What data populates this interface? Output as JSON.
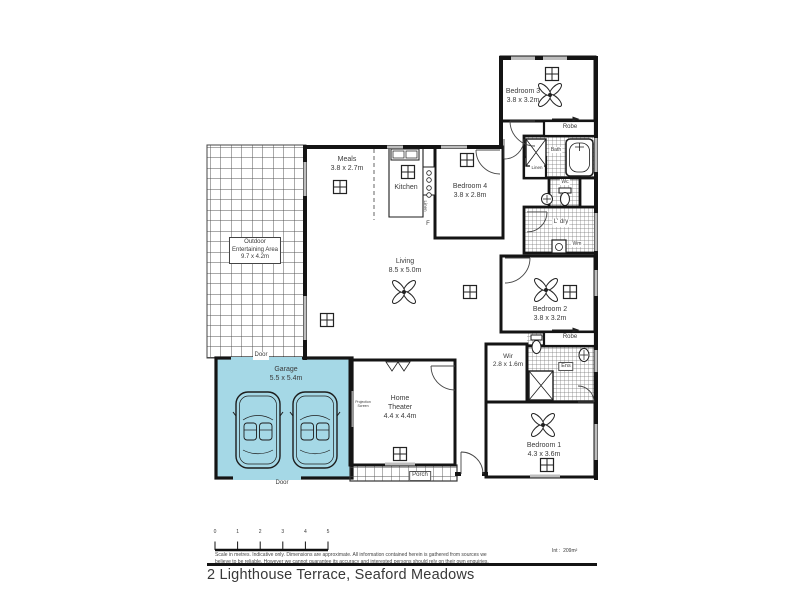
{
  "title": "2 Lighthouse Terrace, Seaford Meadows",
  "colors": {
    "garage_fill": "#a5d8e6",
    "wall": "#141414"
  },
  "rooms": {
    "outdoor": {
      "line1": "Outdoor",
      "line2": "Entertaining Area",
      "dims": "9.7 x 4.2m"
    },
    "meals": {
      "name": "Meals",
      "dims": "3.8 x 2.7m"
    },
    "kitchen": {
      "name": "Kitchen"
    },
    "fridge": "F",
    "linen_hall": "Linen",
    "bedroom4": {
      "name": "Bedroom 4",
      "dims": "3.8 x 2.8m"
    },
    "bedroom3": {
      "name": "Bedroom 3",
      "dims": "3.8 x 3.2m"
    },
    "robe_bed3": "Robe",
    "bath": "Bath",
    "linen_bath": "Linen",
    "wc": "Wc",
    "laundry": "L' dry",
    "washing_machine": "Wm",
    "living": {
      "name": "Living",
      "dims": "8.5 x 5.0m"
    },
    "bedroom2": {
      "name": "Bedroom 2",
      "dims": "3.8 x 3.2m"
    },
    "robe_bed2": "Robe",
    "ensuite": "Ens",
    "wir": {
      "name": "Wir",
      "dims": "2.8 x 1.6m"
    },
    "bedroom1": {
      "name": "Bedroom 1",
      "dims": "4.3 x 3.6m"
    },
    "garage": {
      "name": "Garage",
      "dims": "5.5 x 5.4m"
    },
    "door_top": "Door",
    "door_bottom": "Door",
    "theater": {
      "line1": "Home",
      "line2": "Theater",
      "dims": "4.4 x 4.4m"
    },
    "projection": {
      "line1": "Projection",
      "line2": "Screen"
    },
    "porch": "Porch"
  },
  "footer": {
    "scale_ticks": [
      "0",
      "1",
      "2",
      "3",
      "4",
      "5"
    ],
    "disclaimer_line1": "Scale in metres. Indicative only. Dimensions are approximate. All information contained herein is gathered from sources we",
    "disclaimer_line2": "believe to be reliable. However we cannot guarantee its accuracy and interested persons should rely on their own enquiries.",
    "internal_label": "Int :",
    "internal_value": "209m²"
  }
}
